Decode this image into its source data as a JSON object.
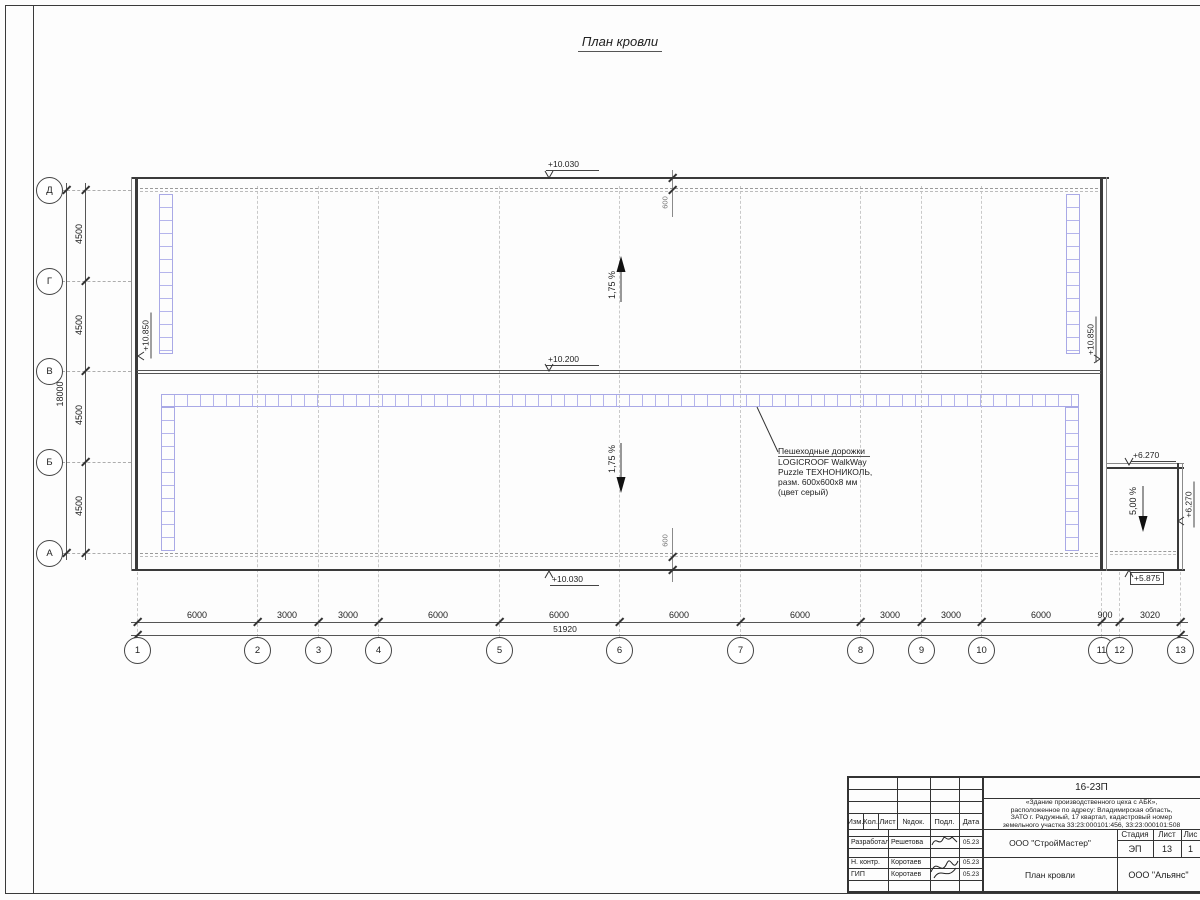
{
  "title": "План кровли",
  "drawing": {
    "slope_main_up": "1,75 %",
    "slope_main_down": "1,75 %",
    "slope_annex": "5,00 %",
    "elev_top": "+10.030",
    "elev_ridge": "+10.200",
    "elev_bottom": "+10.030",
    "elev_left_wall": "+10.850",
    "elev_right_wall": "+10.850",
    "elev_annex_top": "+6.270",
    "elev_annex_right": "+6.270",
    "elev_annex_bottom": "+5.875",
    "parapet_offset_top": "600",
    "parapet_offset_bottom": "600",
    "walkway_note": [
      "Пешеходные дорожки",
      "LOGICROOF WalkWay",
      "Puzzle ТЕХНОНИКОЛЬ,",
      "разм. 600x600x8 мм",
      "(цвет серый)"
    ]
  },
  "axes": {
    "columns": [
      "1",
      "2",
      "3",
      "4",
      "5",
      "6",
      "7",
      "8",
      "9",
      "10",
      "11",
      "12",
      "13"
    ],
    "rows": [
      "Д",
      "Г",
      "В",
      "Б",
      "А"
    ],
    "bottom_dims": [
      "6000",
      "3000",
      "3000",
      "6000",
      "6000",
      "6000",
      "6000",
      "3000",
      "3000",
      "6000",
      "900",
      "3020"
    ],
    "bottom_total": "51920",
    "left_dims": [
      "4500",
      "4500",
      "4500",
      "4500"
    ],
    "left_total": "18000"
  },
  "title_block": {
    "doc_number": "16-23П",
    "project_lines": [
      "«Здание производственного цеха с АБК»,",
      "расположенное по адресу: Владимирская область,",
      "ЗАТО г. Радужный, 17 квартал, кадастровый номер",
      "земельного участка 33:23:000101:456, 33:23:000101:508"
    ],
    "organization": "ООО \"СтройМастер\"",
    "sheet_title": "План кровли",
    "company2": "ООО \"Альянс\"",
    "stage_label": "Стадия",
    "sheet_label": "Лист",
    "sheets_label": "Лис",
    "stage": "ЭП",
    "sheet": "13",
    "sheets": "1",
    "header_cols": [
      "Изм.",
      "Кол.",
      "Лист",
      "№док.",
      "Подл.",
      "Дата"
    ],
    "rows": [
      {
        "role": "Разработал",
        "name": "Решетова",
        "date": "05.23"
      },
      {
        "role": "Н. контр.",
        "name": "Коротаев",
        "date": "05.23"
      },
      {
        "role": "ГИП",
        "name": "Коротаев",
        "date": "05.23"
      }
    ]
  }
}
